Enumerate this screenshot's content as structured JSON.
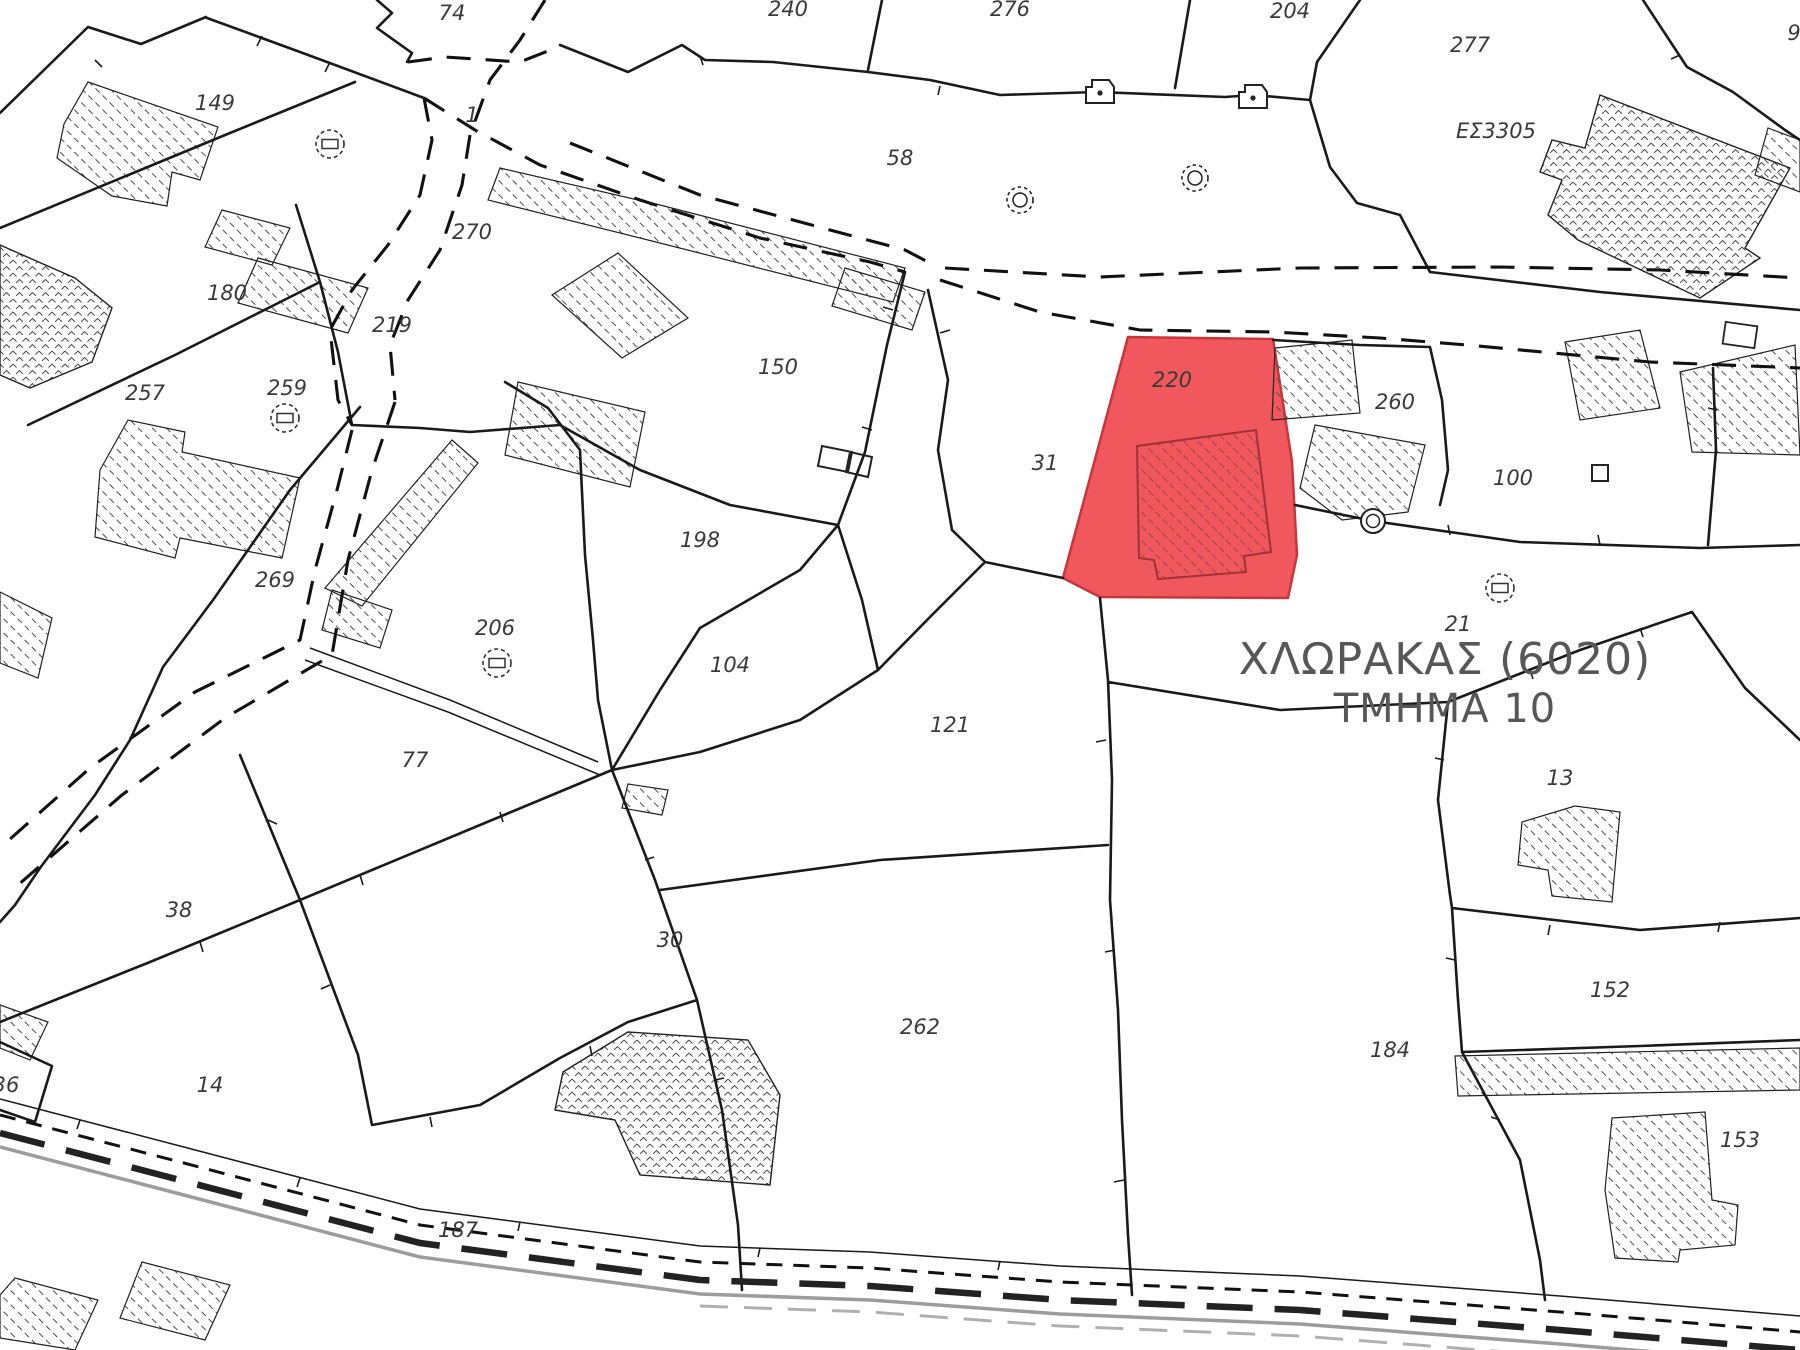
{
  "map": {
    "region_title_line1": "ΧΛΩΡΑΚΑΣ (6020)",
    "region_title_line2": "ΤΜΗΜΑ 10",
    "highlighted_parcel": "220",
    "highlight_fill": "#f1585e",
    "highlight_border": "#c9353c",
    "boundary_color": "#1a1a1a",
    "label_color": "#3a3a3a",
    "title_color": "#575757"
  },
  "labels": [
    {
      "text": "74",
      "x": 452,
      "y": 20
    },
    {
      "text": "149",
      "x": 215,
      "y": 110
    },
    {
      "text": "1",
      "x": 472,
      "y": 122
    },
    {
      "text": "240",
      "x": 788,
      "y": 16
    },
    {
      "text": "276",
      "x": 1010,
      "y": 16
    },
    {
      "text": "204",
      "x": 1290,
      "y": 18
    },
    {
      "text": "277",
      "x": 1470,
      "y": 52
    },
    {
      "text": "9",
      "x": 1794,
      "y": 40
    },
    {
      "text": "ΕΣ3305",
      "x": 1496,
      "y": 138,
      "size": 23
    },
    {
      "text": "58",
      "x": 900,
      "y": 165
    },
    {
      "text": "270",
      "x": 472,
      "y": 239
    },
    {
      "text": "180",
      "x": 227,
      "y": 300
    },
    {
      "text": "219",
      "x": 392,
      "y": 332
    },
    {
      "text": "150",
      "x": 778,
      "y": 374
    },
    {
      "text": "257",
      "x": 145,
      "y": 400
    },
    {
      "text": "259",
      "x": 287,
      "y": 395
    },
    {
      "text": "220",
      "x": 1172,
      "y": 387,
      "color": "#87474c"
    },
    {
      "text": "260",
      "x": 1395,
      "y": 409
    },
    {
      "text": "31",
      "x": 1045,
      "y": 470
    },
    {
      "text": "100",
      "x": 1513,
      "y": 485
    },
    {
      "text": "198",
      "x": 700,
      "y": 547
    },
    {
      "text": "269",
      "x": 275,
      "y": 587
    },
    {
      "text": "206",
      "x": 495,
      "y": 635
    },
    {
      "text": "21",
      "x": 1458,
      "y": 631,
      "size": 16
    },
    {
      "text": "104",
      "x": 730,
      "y": 672
    },
    {
      "text": "121",
      "x": 950,
      "y": 732
    },
    {
      "text": "77",
      "x": 415,
      "y": 767
    },
    {
      "text": "13",
      "x": 1560,
      "y": 785
    },
    {
      "text": "38",
      "x": 179,
      "y": 917
    },
    {
      "text": "30",
      "x": 670,
      "y": 947
    },
    {
      "text": "152",
      "x": 1610,
      "y": 997
    },
    {
      "text": "262",
      "x": 920,
      "y": 1034
    },
    {
      "text": "184",
      "x": 1390,
      "y": 1057
    },
    {
      "text": "14",
      "x": 210,
      "y": 1092
    },
    {
      "text": "36",
      "x": 6,
      "y": 1092
    },
    {
      "text": "187",
      "x": 458,
      "y": 1237
    },
    {
      "text": "153",
      "x": 1740,
      "y": 1147
    }
  ],
  "icons": [
    {
      "name": "well-icon",
      "x": 330,
      "y": 144
    },
    {
      "name": "well-icon",
      "x": 285,
      "y": 418
    },
    {
      "name": "well-icon",
      "x": 497,
      "y": 663
    },
    {
      "name": "well-icon",
      "x": 1500,
      "y": 588
    },
    {
      "name": "ring-dashed-icon",
      "x": 1020,
      "y": 200
    },
    {
      "name": "ring-dashed-icon",
      "x": 1195,
      "y": 178
    },
    {
      "name": "ring-icon",
      "x": 1373,
      "y": 521
    },
    {
      "name": "house-icon",
      "x": 1100,
      "y": 92
    },
    {
      "name": "house-icon",
      "x": 1253,
      "y": 97
    },
    {
      "name": "square-icon",
      "x": 1600,
      "y": 473
    },
    {
      "name": "rect-icon",
      "x": 1740,
      "y": 335
    }
  ]
}
